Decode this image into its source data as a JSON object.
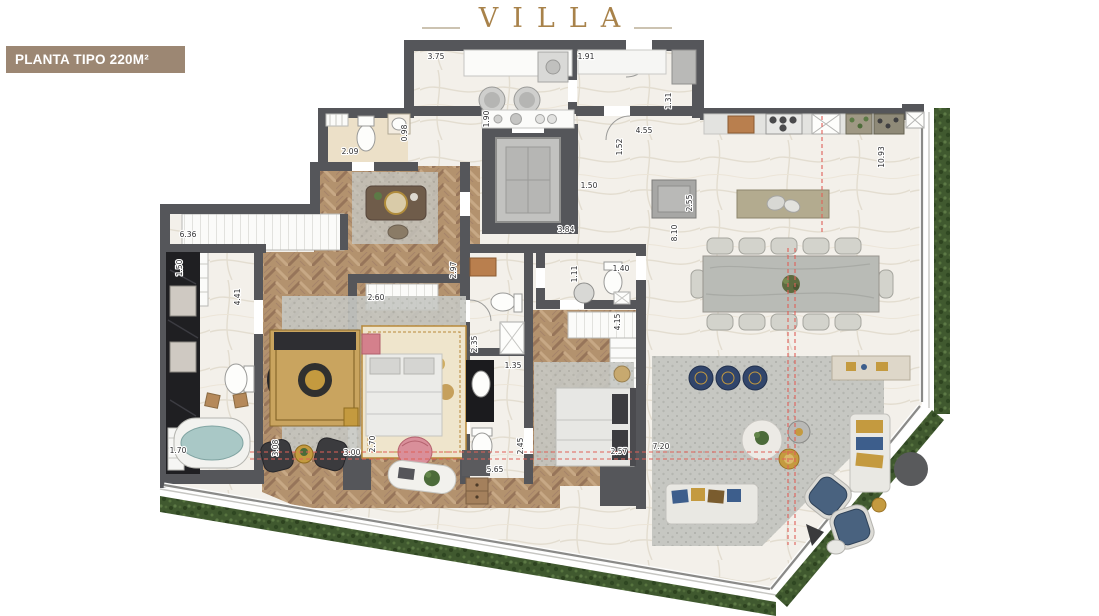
{
  "header": {
    "title": "VILLA",
    "badge": "PLANTA TIPO 220M²"
  },
  "colors": {
    "title_gold": "#a8824a",
    "badge_bg": "#9c8773",
    "badge_text": "#ffffff",
    "wall": "#55565a",
    "wood_floor": "#b3926e",
    "marble_floor": "#f3f0ea",
    "cream_floor": "#ece0c8",
    "black_marble": "#1f1f22",
    "hedge_green": "#40592f",
    "rug_gray": "#c6c7c2",
    "section_line_red": "#e06058",
    "tub_water": "#a9c8c6",
    "accent_gold": "#c49a3f",
    "accent_blue": "#3d5e8c",
    "accent_pink": "#d4808c"
  },
  "plan": {
    "dimensions": [
      {
        "v": "3.75",
        "x": 436,
        "y": 59,
        "r": 0
      },
      {
        "v": "1.91",
        "x": 586,
        "y": 59,
        "r": 0
      },
      {
        "v": "0.98",
        "x": 407,
        "y": 133,
        "r": -90
      },
      {
        "v": "2.09",
        "x": 350,
        "y": 154,
        "r": 0
      },
      {
        "v": "1.90",
        "x": 489,
        "y": 119,
        "r": -90
      },
      {
        "v": "1.31",
        "x": 671,
        "y": 101,
        "r": -90
      },
      {
        "v": "4.55",
        "x": 644,
        "y": 133,
        "r": 0
      },
      {
        "v": "1.52",
        "x": 622,
        "y": 147,
        "r": -90
      },
      {
        "v": "1.50",
        "x": 589,
        "y": 188,
        "r": 0
      },
      {
        "v": "3.84",
        "x": 566,
        "y": 232,
        "r": 0
      },
      {
        "v": "2.55",
        "x": 692,
        "y": 203,
        "r": -90
      },
      {
        "v": "8.10",
        "x": 677,
        "y": 233,
        "r": -90
      },
      {
        "v": "10.93",
        "x": 884,
        "y": 157,
        "r": -90
      },
      {
        "v": "6.36",
        "x": 188,
        "y": 237,
        "r": 0
      },
      {
        "v": "1.50",
        "x": 182,
        "y": 268,
        "r": -90
      },
      {
        "v": "4.41",
        "x": 240,
        "y": 297,
        "r": -90
      },
      {
        "v": "2.60",
        "x": 376,
        "y": 300,
        "r": 0
      },
      {
        "v": "2.97",
        "x": 456,
        "y": 270,
        "r": -90
      },
      {
        "v": "2.35",
        "x": 477,
        "y": 344,
        "r": -90
      },
      {
        "v": "1.35",
        "x": 513,
        "y": 368,
        "r": 0
      },
      {
        "v": "1.11",
        "x": 577,
        "y": 274,
        "r": -90
      },
      {
        "v": "1.40",
        "x": 621,
        "y": 271,
        "r": 0
      },
      {
        "v": "4.15",
        "x": 620,
        "y": 322,
        "r": -90
      },
      {
        "v": "1.70",
        "x": 178,
        "y": 453,
        "r": 0
      },
      {
        "v": "3.08",
        "x": 278,
        "y": 448,
        "r": -90
      },
      {
        "v": "3.00",
        "x": 352,
        "y": 455,
        "r": 0
      },
      {
        "v": "2.70",
        "x": 375,
        "y": 444,
        "r": -90
      },
      {
        "v": "5.65",
        "x": 495,
        "y": 472,
        "r": 0
      },
      {
        "v": "2.45",
        "x": 523,
        "y": 446,
        "r": -90
      },
      {
        "v": "2.57",
        "x": 619,
        "y": 454,
        "r": 0
      },
      {
        "v": "7.20",
        "x": 661,
        "y": 449,
        "r": 0
      }
    ]
  }
}
